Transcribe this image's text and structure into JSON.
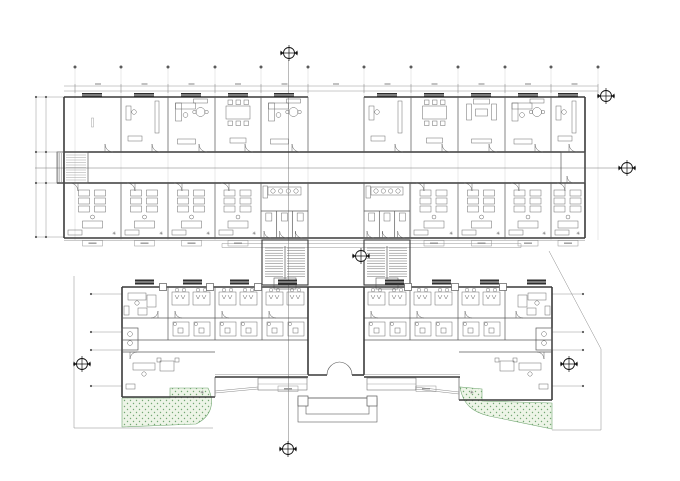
{
  "drawing": {
    "type": "architectural-floor-plan",
    "canvas": {
      "width": 680,
      "height": 481,
      "background": "#ffffff"
    },
    "palette": {
      "wall": "#3a3a3a",
      "partition": "#5a5a5a",
      "thin": "#8a8a8a",
      "faint": "#bdbdbd",
      "furniture": "#6a6a6a",
      "marker": "#111111",
      "window_fill": "#2e2e2e",
      "green_fill": "#edf4e7",
      "green_dot": "#74a874",
      "label_dash": "#9a9a9a"
    },
    "symbols": {
      "asterisk": "✳"
    },
    "grid": {
      "columns_x": [
        75,
        121,
        168,
        215,
        261,
        308,
        364,
        411,
        458,
        505,
        551,
        598
      ],
      "bubble_y": 67,
      "grid_top": 67,
      "grid_bottom": 240,
      "dim_lines_y": [
        86,
        91
      ],
      "dim_x1": 64,
      "dim_x2": 598
    },
    "left_dims": {
      "cols_x": [
        36,
        46
      ],
      "dots_y": [
        97,
        152,
        183,
        237
      ],
      "leader_x2": 64
    },
    "side_leaders": [
      {
        "x": 91,
        "x2": 122,
        "ys": [
          294,
          332,
          350,
          386
        ]
      },
      {
        "x": 583,
        "x2": 552,
        "ys": [
          294,
          332,
          350,
          386
        ]
      }
    ],
    "section": {
      "v_x": 288.5,
      "v_y1": 60,
      "v_y2": 443,
      "h_y": 168,
      "h_x1": 35,
      "h_x2": 620
    },
    "markers": [
      {
        "x": 289,
        "y": 53
      },
      {
        "x": 627,
        "y": 168
      },
      {
        "x": 361,
        "y": 256
      },
      {
        "x": 82,
        "y": 364
      },
      {
        "x": 569,
        "y": 364
      },
      {
        "x": 288,
        "y": 449
      },
      {
        "x": 606,
        "y": 96
      }
    ],
    "upper": {
      "x1": 64,
      "x2": 585,
      "top": 97,
      "corr1": 152,
      "corr2": 183,
      "bottom": 238,
      "gap": [
        308,
        364
      ],
      "partitions_A": [
        121,
        168,
        215,
        261,
        411,
        458,
        505,
        551
      ],
      "wings_A": [
        [
          64,
          308
        ],
        [
          364,
          585
        ]
      ],
      "partitions_B": [
        121,
        168,
        215,
        458,
        505,
        551
      ],
      "rooms_B": [
        [
          64,
          121
        ],
        [
          121,
          168
        ],
        [
          168,
          215
        ],
        [
          215,
          261
        ],
        [
          410,
          458
        ],
        [
          458,
          505
        ],
        [
          505,
          551
        ],
        [
          551,
          585
        ]
      ],
      "cores": [
        [
          261,
          308
        ],
        [
          364,
          410
        ]
      ],
      "stubs": [
        [
          57,
          88
        ],
        [
          561,
          585
        ]
      ],
      "windows_A_mid": [
        92,
        144,
        191,
        238,
        284,
        387,
        434,
        481,
        528,
        568
      ],
      "rooms_A": [
        {
          "x1": 64,
          "x2": 121,
          "f": "empty"
        },
        {
          "x1": 121,
          "x2": 168,
          "f": "counter"
        },
        {
          "x1": 168,
          "x2": 215,
          "f": "exec"
        },
        {
          "x1": 215,
          "x2": 261,
          "f": "meeting"
        },
        {
          "x1": 261,
          "x2": 308,
          "f": "exec"
        },
        {
          "x1": 364,
          "x2": 411,
          "f": "counter"
        },
        {
          "x1": 411,
          "x2": 458,
          "f": "meeting"
        },
        {
          "x1": 458,
          "x2": 505,
          "f": "lounge"
        },
        {
          "x1": 505,
          "x2": 551,
          "f": "exec"
        },
        {
          "x1": 551,
          "x2": 585,
          "f": "counter"
        }
      ]
    },
    "link": {
      "canopy_y": [
        243.5,
        247.5
      ],
      "canopy_x": [
        222,
        521
      ],
      "stairs_x": [
        262,
        364
      ],
      "stair_w": 46,
      "stair_y1": 240,
      "stair_y2": 285
    },
    "lower": {
      "x1": 122,
      "x2": 552,
      "top": 287,
      "mid1": 318,
      "mid2": 340,
      "corr": 352,
      "bottom_left": 397,
      "bottom_right": 400,
      "hall": [
        308,
        364
      ],
      "workrooms": [
        [
          168,
          215
        ],
        [
          215,
          262
        ],
        [
          262,
          308
        ],
        [
          364,
          410
        ],
        [
          410,
          458
        ],
        [
          458,
          505
        ]
      ],
      "partitions_C": [
        168,
        215,
        262,
        410,
        458,
        505
      ],
      "office_tl": [
        122,
        168
      ],
      "office_tr": [
        506,
        552
      ],
      "office_bl": [
        122,
        215
      ],
      "office_br": [
        459,
        552
      ],
      "wc_left": [
        122,
        138,
        328,
        350
      ],
      "wc_right": [
        536,
        552,
        328,
        350
      ],
      "columns_x": [
        163,
        210,
        258,
        408,
        455,
        503
      ],
      "ac_x": [
        135,
        183,
        230,
        278,
        385,
        432,
        480,
        527
      ],
      "front_y": 377,
      "front_win_left": [
        215,
        308
      ],
      "front_win_right": [
        364,
        460
      ],
      "door_x": [
        327,
        352
      ],
      "door_y": 375,
      "door_r": 13,
      "porch": {
        "piers": [
          [
            298,
            396
          ],
          [
            367,
            396
          ]
        ],
        "steps": [
          [
            298,
            398,
            79,
            24
          ],
          [
            306,
            398,
            63,
            16
          ]
        ]
      },
      "ramps": [
        [
          258,
          378,
          49,
          12
        ],
        [
          367,
          378,
          49,
          12
        ]
      ],
      "sill_boxes": [
        [
          288,
          386
        ],
        [
          426,
          386
        ]
      ],
      "walk_diag": [
        [
          215,
          391,
          258,
          387
        ],
        [
          415,
          387,
          459,
          392
        ]
      ]
    },
    "site": {
      "left_boundary": "M74,276 L74,428 L213,428",
      "right_boundary": "M549,251 L601,349 L601,430 L552,430",
      "green_left": "M170,388 L208,388 C215,402 212,416 196,424 L122,427 L122,398 L170,398 Z",
      "green_right": "M460,387 C463,405 473,412 489,416 L552,429 L552,403 L482,401 L482,389 Z"
    }
  }
}
